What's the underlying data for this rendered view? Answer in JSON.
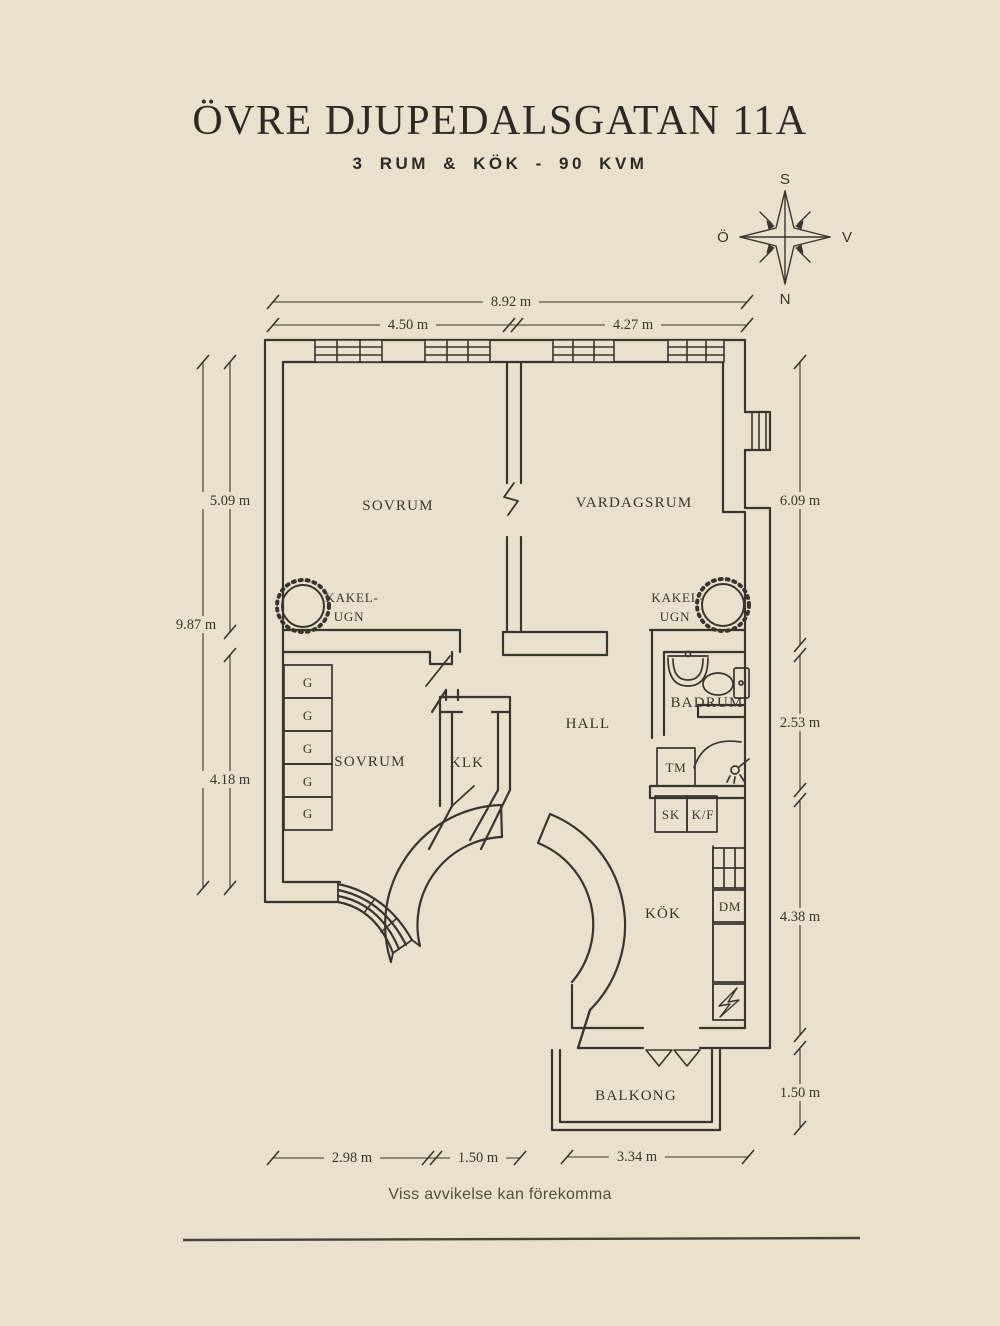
{
  "colors": {
    "background": "#e9e1cd",
    "ink": "#3a352c"
  },
  "header": {
    "title": "ÖVRE DJUPEDALSGATAN 11A",
    "subtitle": "3 RUM & KÖK  -  90 KVM"
  },
  "compass": {
    "north": "N",
    "south": "S",
    "east": "Ö",
    "west": "V"
  },
  "rooms": {
    "sovrum1": "SOVRUM",
    "vardagsrum": "VARDAGSRUM",
    "sovrum2": "SOVRUM",
    "klk": "KLK",
    "hall": "HALL",
    "badrum": "BADRUM",
    "kok": "KÖK",
    "balkong": "BALKONG"
  },
  "fixtures": {
    "kakelugn_line1": "KAKEL-",
    "kakelugn_line2": "UGN",
    "tm": "TM",
    "sk": "SK",
    "kf": "K/F",
    "dm": "DM",
    "g": [
      "G",
      "G",
      "G",
      "G",
      "G"
    ]
  },
  "dimensions": {
    "total_width": "8.92 m",
    "top_left": "4.50 m",
    "top_right": "4.27 m",
    "left_total": "9.87 m",
    "left_upper": "5.09 m",
    "left_lower": "4.18 m",
    "right_upper": "6.09 m",
    "right_middle": "2.53 m",
    "right_lower": "4.38 m",
    "balcony_height": "1.50 m",
    "bottom_left": "2.98 m",
    "bottom_middle": "1.50 m",
    "balcony_width": "3.34 m"
  },
  "footer": {
    "disclaimer": "Viss avvikelse kan förekomma"
  }
}
